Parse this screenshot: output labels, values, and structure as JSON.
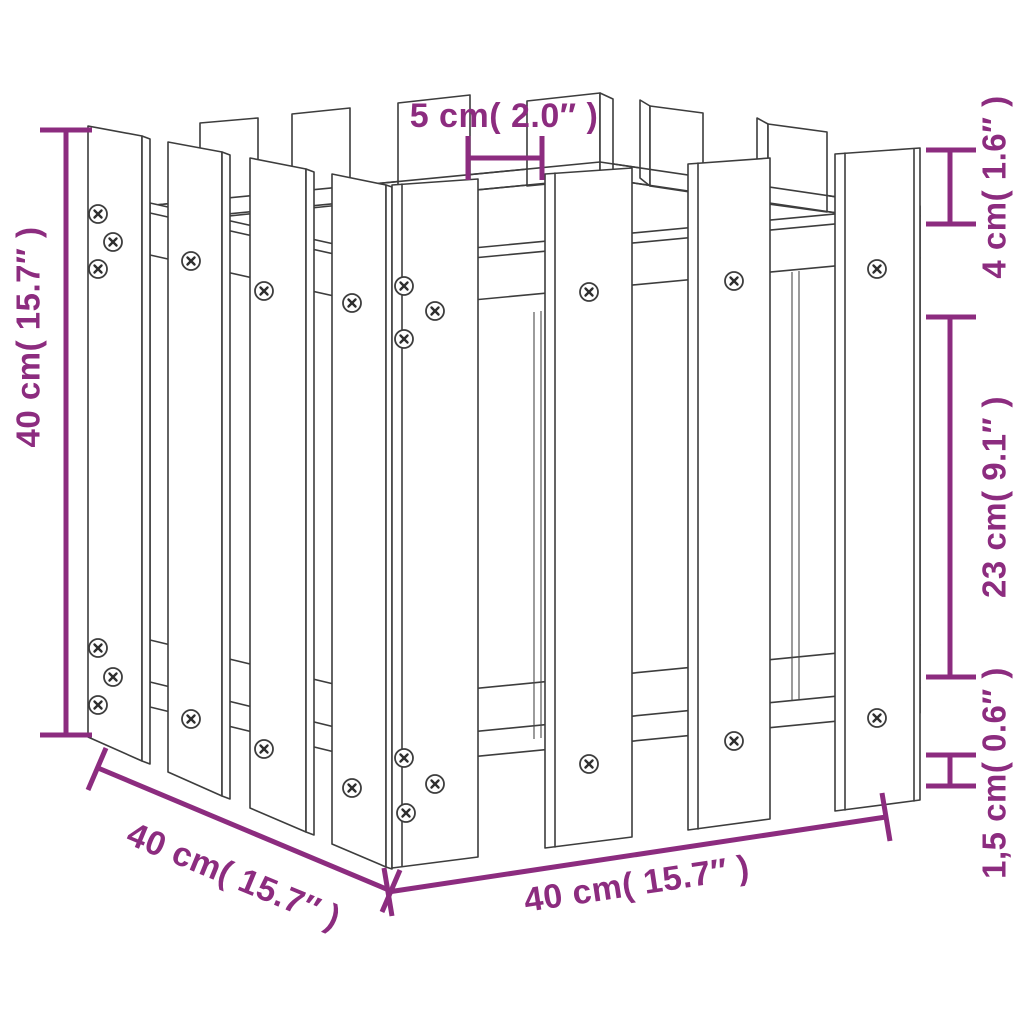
{
  "colors": {
    "accent": "#8C2C7F",
    "line": "#3D3D3D",
    "background": "#FFFFFF"
  },
  "dimensions": {
    "top_gap": {
      "label": "5 cm( 2.0″ )"
    },
    "right_top": {
      "label": "4 cm( 1.6″ )"
    },
    "right_middle": {
      "label": "23 cm( 9.1″ )"
    },
    "right_bottom": {
      "label": "1,5 cm( 0.6″ )"
    },
    "left_height": {
      "label": "40 cm( 15.7″ )"
    },
    "bottom_depth": {
      "label": "40 cm( 15.7″ )"
    },
    "bottom_width": {
      "label": "40 cm( 15.7″ )"
    }
  }
}
